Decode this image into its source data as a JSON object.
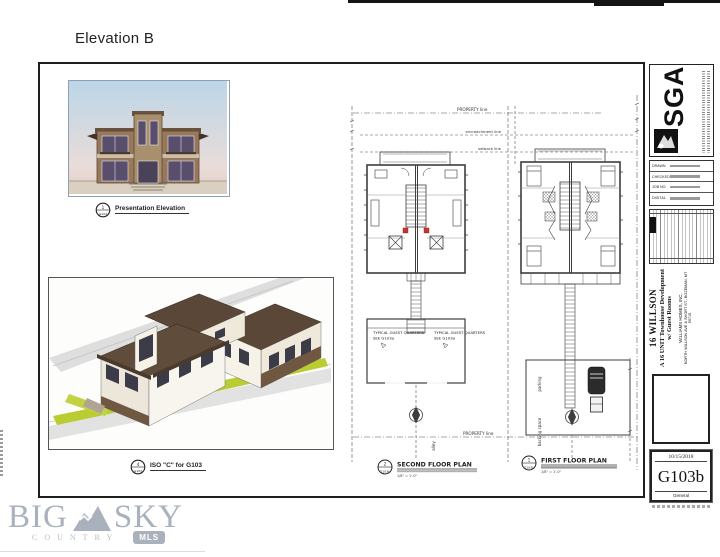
{
  "page": {
    "label": "Elevation B"
  },
  "figures": {
    "elevation": {
      "marker_num": "1",
      "marker_ref": "G103",
      "caption": "Presentation Elevation"
    },
    "iso": {
      "marker_num": "4",
      "marker_ref": "G103",
      "caption": "ISO \"C\" for G103"
    }
  },
  "plans": {
    "property_line_top": "PROPERTY line",
    "property_line_bottom": "PROPERTY line",
    "encroachment_line": "encroachment line",
    "setback_line": "setback line",
    "guest_quarters": {
      "line1": "TYPICAL GUEST QUARTERS",
      "line2": "SEE G103a"
    },
    "alley": "alley",
    "parking": "parking",
    "backing_space": "backing space",
    "second_floor": {
      "marker_num": "2",
      "marker_ref": "G103b",
      "label": "SECOND FLOOR PLAN",
      "scale": "1/8\" = 1'-0\""
    },
    "first_floor": {
      "marker_num": "1",
      "marker_ref": "G103b",
      "label": "FIRST FLOOR PLAN",
      "scale": "1/8\" = 1'-0\""
    }
  },
  "title_block": {
    "firm_abbr": "SGA",
    "drawn_label": "DRAWN",
    "checked_label": "CHECKED",
    "job_label": "JOB NO.",
    "digital_label": "DIGITAL",
    "project": {
      "name": "16 WILLSON",
      "type": "A 16 UNIT Townhouse Development",
      "type2": "w/ Guest Rooms",
      "client": "WILLIAMS HOMES, INC.",
      "address": "NORTH WILLSON AVE & SHORT ST.,  BOZEMAN, MT 59715"
    },
    "sheet": {
      "date": "10/15/2018",
      "number": "G103b",
      "category": "General"
    }
  },
  "watermark": {
    "big": "BIG",
    "sky": "SKY",
    "country": "COUNTRY",
    "mls": "MLS"
  }
}
